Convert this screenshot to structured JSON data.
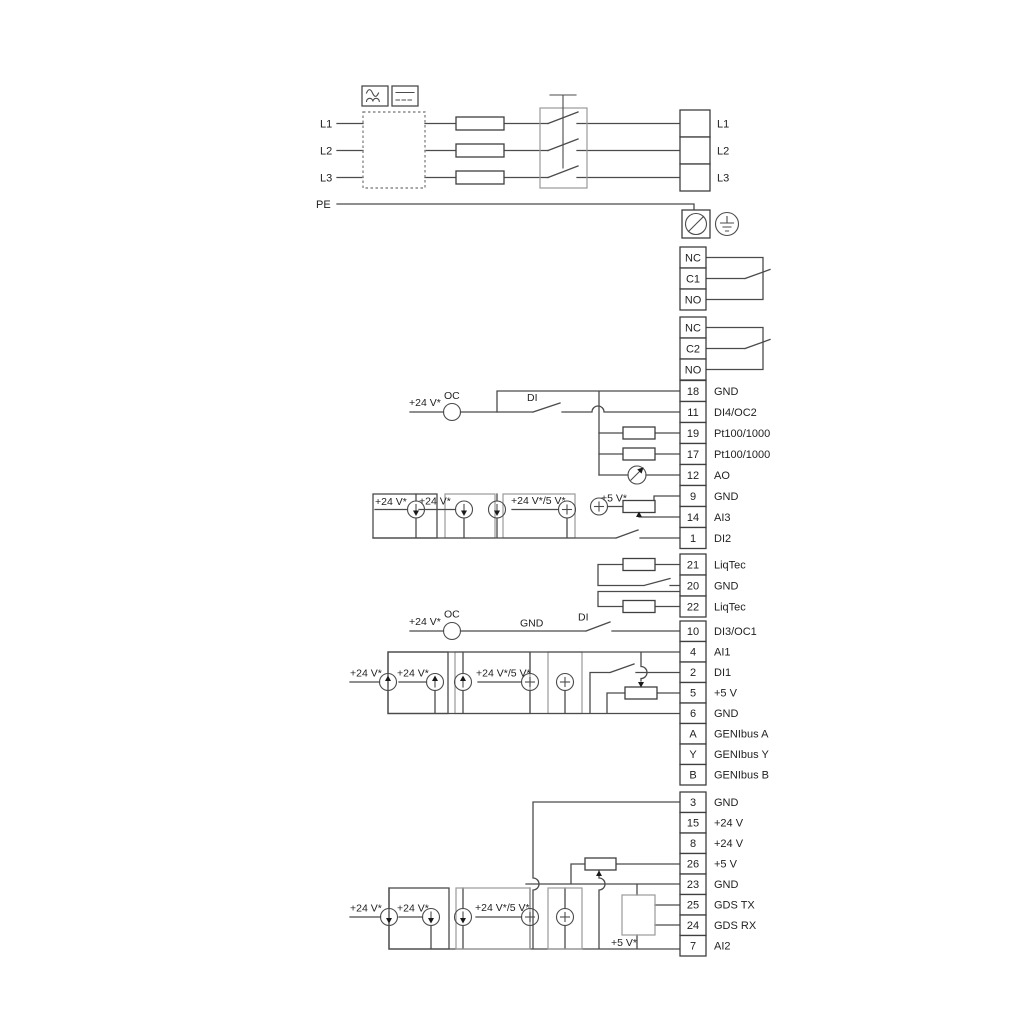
{
  "diagram_title": "",
  "colors": {
    "wire": "#4b4b4b",
    "bracket": "#9a9a9a",
    "text": "#1f1f1f"
  },
  "ann": [
    "L1",
    "L2",
    "L3",
    "PE",
    "+24 V*",
    "OC",
    "DI",
    "+24 V*",
    "+24 V*",
    "+24 V*/5 V*",
    "+5 V*",
    "+24 V*",
    "OC",
    "GND",
    "DI",
    "+24 V*",
    "+24 V*",
    "+24 V*/5 V*",
    "+24 V*",
    "+24 V*",
    "+24 V*/5 V*",
    "+5 V*"
  ],
  "blocks": {
    "power_out": {
      "rows": [
        {
          "num": "",
          "label": "L1"
        },
        {
          "num": "",
          "label": "L2"
        },
        {
          "num": "",
          "label": "L3"
        }
      ]
    },
    "relay1": {
      "rows": [
        {
          "num": "NC",
          "label": ""
        },
        {
          "num": "C1",
          "label": ""
        },
        {
          "num": "NO",
          "label": ""
        }
      ]
    },
    "relay2": {
      "rows": [
        {
          "num": "NC",
          "label": ""
        },
        {
          "num": "C2",
          "label": ""
        },
        {
          "num": "NO",
          "label": ""
        }
      ]
    },
    "b1": {
      "rows": [
        {
          "num": "18",
          "label": "GND"
        },
        {
          "num": "11",
          "label": "DI4/OC2"
        },
        {
          "num": "19",
          "label": "Pt100/1000"
        },
        {
          "num": "17",
          "label": "Pt100/1000"
        },
        {
          "num": "12",
          "label": "AO"
        },
        {
          "num": "9",
          "label": "GND"
        },
        {
          "num": "14",
          "label": "AI3"
        },
        {
          "num": "1",
          "label": "DI2"
        }
      ]
    },
    "liqtec": {
      "rows": [
        {
          "num": "21",
          "label": "LiqTec"
        },
        {
          "num": "20",
          "label": "GND"
        },
        {
          "num": "22",
          "label": "LiqTec"
        }
      ]
    },
    "b3": {
      "rows": [
        {
          "num": "10",
          "label": "DI3/OC1"
        },
        {
          "num": "4",
          "label": "AI1"
        },
        {
          "num": "2",
          "label": "DI1"
        },
        {
          "num": "5",
          "label": "+5 V"
        },
        {
          "num": "6",
          "label": "GND"
        },
        {
          "num": "A",
          "label": "GENIbus A"
        },
        {
          "num": "Y",
          "label": "GENIbus Y"
        },
        {
          "num": "B",
          "label": "GENIbus B"
        }
      ]
    },
    "b4": {
      "rows": [
        {
          "num": "3",
          "label": "GND"
        },
        {
          "num": "15",
          "label": "+24 V"
        },
        {
          "num": "8",
          "label": "+24 V"
        },
        {
          "num": "26",
          "label": "+5 V"
        },
        {
          "num": "23",
          "label": "GND"
        },
        {
          "num": "25",
          "label": "GDS TX"
        },
        {
          "num": "24",
          "label": "GDS RX"
        },
        {
          "num": "7",
          "label": "AI2"
        }
      ]
    }
  }
}
